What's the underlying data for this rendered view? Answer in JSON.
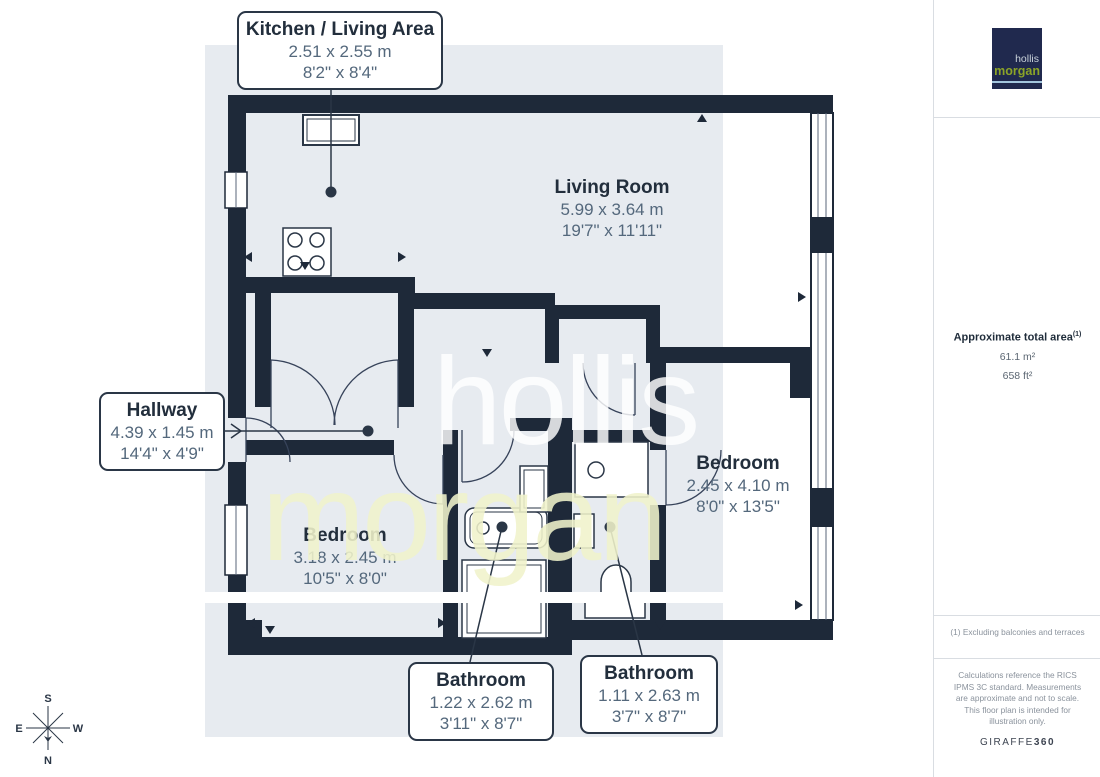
{
  "rooms": {
    "kitchen_living": {
      "name": "Kitchen / Living Area",
      "metric": "2.51 x 2.55 m",
      "imperial": "8'2\" x 8'4\""
    },
    "living_room": {
      "name": "Living Room",
      "metric": "5.99 x 3.64 m",
      "imperial": "19'7\" x 11'11\""
    },
    "hallway": {
      "name": "Hallway",
      "metric": "4.39 x 1.45 m",
      "imperial": "14'4\" x 4'9\""
    },
    "bedroom_small": {
      "name": "Bedroom",
      "metric": "3.18 x 2.45 m",
      "imperial": "10'5\" x 8'0\""
    },
    "bedroom_large": {
      "name": "Bedroom",
      "metric": "2.45 x 4.10 m",
      "imperial": "8'0\" x 13'5\""
    },
    "bathroom_1": {
      "name": "Bathroom",
      "metric": "1.22 x 2.62 m",
      "imperial": "3'11\" x 8'7\""
    },
    "bathroom_2": {
      "name": "Bathroom",
      "metric": "1.11 x 2.63 m",
      "imperial": "3'7\" x 8'7\""
    }
  },
  "sidebar": {
    "area_title": "Approximate total area",
    "area_marker": "(1)",
    "area_m2": "61.1 m²",
    "area_ft2": "658 ft²",
    "footnote": "(1) Excluding balconies and terraces",
    "disclaimer": "Calculations reference the RICS IPMS 3C standard. Measurements are approximate and not to scale. This floor plan is intended for illustration only.",
    "brand_regular": "GIRAFFE",
    "brand_bold": "360"
  },
  "branding": {
    "line1": "hollis",
    "line2": "morgan"
  },
  "watermark": {
    "line1": "hollis",
    "line2": "morgan"
  },
  "compass": {
    "top": "S",
    "bottom": "N",
    "left": "E",
    "right": "W"
  },
  "colors": {
    "wall": "#1e2939",
    "plot_background": "#e7ebf0",
    "label_title": "#222e3c",
    "label_dimensions": "#54687c",
    "logo_background": "#20294e",
    "logo_hollis": "#c9d2da",
    "logo_morgan": "#8ca427",
    "logo_underline": "#a3c6de",
    "watermark_hollis": "rgba(255,255,255,0.82)",
    "watermark_morgan": "rgba(240,243,203,0.88)",
    "sidebar_text": "#8a929c",
    "divider": "#d9dde2"
  }
}
